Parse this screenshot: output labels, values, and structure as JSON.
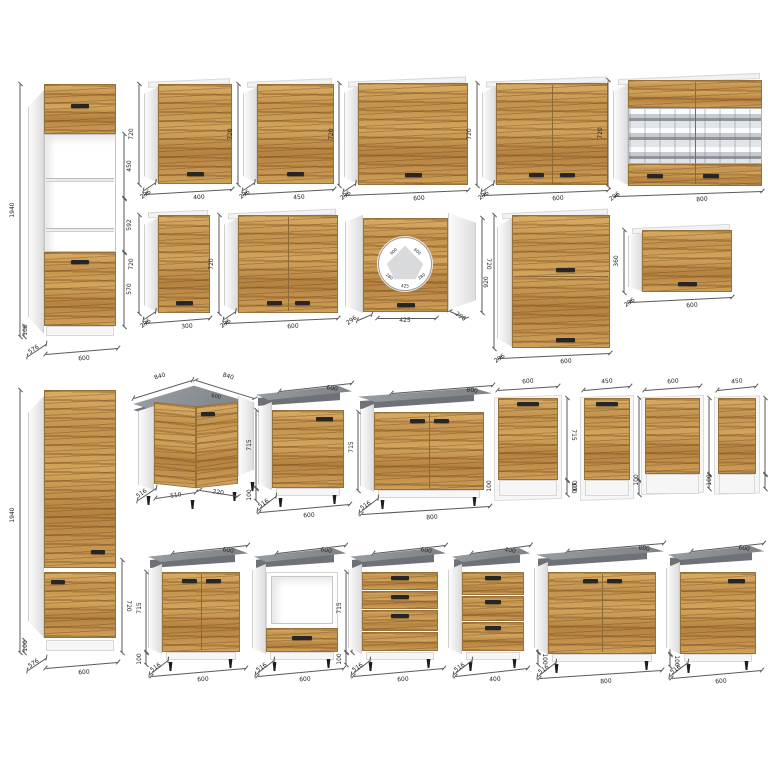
{
  "title": "kitchen-cabinet-modules-catalog",
  "colors": {
    "wood": "#c89a57",
    "carcass_white": "#fdfdfd",
    "countertop_gray": "#8d9296",
    "countertop_edge": "#6e7277",
    "handle_dark": "#262626",
    "dimension_text": "#1f1f1f",
    "background": "#ffffff"
  },
  "modules": [
    {
      "kind": "tallA",
      "name": "tall-cabinet-oven-housing-1940",
      "g": {
        "x": 44,
        "y": 84,
        "w": 72,
        "h": 252
      },
      "labels": {
        "height": "1940",
        "sec1": "450",
        "sec2": "592",
        "sec3": "570",
        "plinth": "100",
        "depth": "576",
        "width": "600"
      }
    },
    {
      "kind": "wall",
      "name": "wall-cabinet-400",
      "g": {
        "x": 158,
        "y": 84,
        "w": 74,
        "h": 100,
        "doors": 1
      },
      "labels": {
        "width": "400",
        "height": "720",
        "depth": "296"
      }
    },
    {
      "kind": "wall",
      "name": "wall-cabinet-450",
      "g": {
        "x": 257,
        "y": 84,
        "w": 77,
        "h": 100,
        "doors": 1
      },
      "labels": {
        "width": "450",
        "height": "720",
        "depth": "296"
      }
    },
    {
      "kind": "wall",
      "name": "wall-cabinet-600",
      "g": {
        "x": 358,
        "y": 83,
        "w": 110,
        "h": 102,
        "doors": 1
      },
      "labels": {
        "width": "600",
        "height": "720",
        "depth": "296"
      }
    },
    {
      "kind": "wall",
      "name": "wall-cabinet-600-two-door",
      "g": {
        "x": 496,
        "y": 83,
        "w": 112,
        "h": 102,
        "doors": 2
      },
      "labels": {
        "width": "600",
        "height": "720",
        "depth": "296"
      }
    },
    {
      "kind": "wallGlass",
      "name": "wall-cabinet-800-glass",
      "g": {
        "x": 628,
        "y": 80,
        "w": 134,
        "h": 106
      },
      "labels": {
        "width": "800",
        "height": "720",
        "depth": "296"
      }
    },
    {
      "kind": "wall",
      "name": "wall-cabinet-300",
      "g": {
        "x": 158,
        "y": 215,
        "w": 52,
        "h": 98,
        "doors": 1
      },
      "labels": {
        "width": "300",
        "height": "720",
        "depth": "296"
      }
    },
    {
      "kind": "wall",
      "name": "wall-cabinet-600-two-door-b",
      "g": {
        "x": 238,
        "y": 215,
        "w": 100,
        "h": 98,
        "doors": 2
      },
      "labels": {
        "width": "600",
        "height": "720",
        "depth": "296"
      }
    },
    {
      "kind": "wallCorner",
      "name": "wall-corner-cabinet-600",
      "g": {
        "x": 345,
        "y": 213
      },
      "labels": {
        "front": "425",
        "height": "720",
        "depth_left": "296",
        "depth_right": "296",
        "plan": [
          "600",
          "600",
          "280",
          "280",
          "425"
        ]
      }
    },
    {
      "kind": "wallStack",
      "name": "wall-cabinet-600-920-stacked",
      "g": {
        "x": 512,
        "y": 215,
        "w": 98,
        "h": 133
      },
      "labels": {
        "width": "600",
        "height": "920",
        "depth": "296"
      }
    },
    {
      "kind": "wallHoriz",
      "name": "wall-cabinet-600-360-horizontal",
      "g": {
        "x": 642,
        "y": 230,
        "w": 90,
        "h": 62
      },
      "labels": {
        "width": "600",
        "height": "360",
        "depth": "296"
      }
    },
    {
      "kind": "tallB",
      "name": "tall-cabinet-1940-fridge",
      "g": {
        "x": 44,
        "y": 390,
        "w": 72,
        "h": 250
      },
      "labels": {
        "height": "1940",
        "section": "720",
        "plinth": "100",
        "depth": "576",
        "width": "600"
      }
    },
    {
      "kind": "baseCorner",
      "name": "base-corner-cabinet-840",
      "g": {
        "x": 128
      },
      "labels": {
        "top_left": "840",
        "top_right": "840",
        "counter": "600",
        "depth": "516",
        "front_left": "510",
        "front_right": "220"
      }
    },
    {
      "kind": "base",
      "name": "base-cabinet-600-door",
      "g": {
        "x": 256,
        "y": 386,
        "cw": 96,
        "fx": 272,
        "fy": 410,
        "fw": 72,
        "fh": 78,
        "type": "door1",
        "hside": "left"
      },
      "labels": {
        "top": "600",
        "height": "715",
        "plinth": "100",
        "depth": "516",
        "width": "600"
      }
    },
    {
      "kind": "base",
      "name": "base-cabinet-800-two-door",
      "g": {
        "x": 358,
        "y": 388,
        "cw": 134,
        "fx": 374,
        "fy": 412,
        "fw": 110,
        "fh": 78,
        "type": "door2",
        "hside": "left"
      },
      "labels": {
        "top": "800",
        "height": "715",
        "depth": "516",
        "width": "800"
      }
    },
    {
      "kind": "dw",
      "name": "dishwasher-front-600-715",
      "g": {
        "x": 498,
        "y": 398,
        "w": 60,
        "h": 82,
        "handle": true
      },
      "labels": {
        "top": "600",
        "height": "715",
        "plinth": "100"
      }
    },
    {
      "kind": "dw",
      "name": "dishwasher-front-450-715",
      "g": {
        "x": 584,
        "y": 398,
        "w": 46,
        "h": 82,
        "handle": true
      },
      "labels": {
        "top": "450",
        "height": "715",
        "plinth": "100"
      }
    },
    {
      "kind": "dw",
      "name": "dishwasher-front-600-570",
      "g": {
        "x": 645,
        "y": 398,
        "w": 55,
        "h": 76,
        "handle": false
      },
      "labels": {
        "top": "600",
        "height": "570",
        "plinth": "100"
      }
    },
    {
      "kind": "dw",
      "name": "dishwasher-front-450-570",
      "g": {
        "x": 718,
        "y": 398,
        "w": 38,
        "h": 76,
        "handle": false
      },
      "labels": {
        "top": "450",
        "height": "570",
        "plinth": "100"
      }
    },
    {
      "kind": "base",
      "name": "base-cabinet-600-two-door-sink",
      "g": {
        "x": 148,
        "y": 548,
        "cw": 100,
        "fx": 162,
        "fy": 572,
        "fw": 78,
        "fh": 80,
        "type": "door2",
        "hside": "left"
      },
      "labels": {
        "top": "600",
        "height": "715",
        "plinth": "100",
        "depth": "516",
        "width": "600"
      }
    },
    {
      "kind": "base",
      "name": "base-cabinet-oven-housing-600",
      "g": {
        "x": 254,
        "y": 548,
        "cw": 92,
        "fx": 266,
        "fy": 572,
        "fw": 72,
        "fh": 80,
        "type": "oven",
        "hside": "right"
      },
      "labels": {
        "top": "600",
        "height": "715",
        "depth": "516",
        "width": "600"
      }
    },
    {
      "kind": "base",
      "name": "base-cabinet-600-drawers",
      "g": {
        "x": 350,
        "y": 548,
        "cw": 96,
        "fx": 362,
        "fy": 572,
        "fw": 76,
        "fh": 80,
        "type": "drawers4",
        "hside": "left"
      },
      "labels": {
        "top": "600",
        "height": "715",
        "plinth": "100",
        "depth": "516",
        "width": "600"
      }
    },
    {
      "kind": "base",
      "name": "base-cabinet-400-drawers",
      "g": {
        "x": 452,
        "y": 548,
        "cw": 78,
        "fx": 462,
        "fy": 572,
        "fw": 62,
        "fh": 80,
        "type": "drawers3",
        "hside": "right"
      },
      "labels": {
        "top": "400",
        "height": "715",
        "plinth": "100",
        "depth": "516",
        "width": "400"
      }
    },
    {
      "kind": "base",
      "name": "base-cabinet-800-two-door-b",
      "g": {
        "x": 536,
        "y": 546,
        "cw": 128,
        "fx": 548,
        "fy": 572,
        "fw": 108,
        "fh": 82,
        "type": "door2",
        "hside": "right"
      },
      "labels": {
        "top": "800",
        "height": "715",
        "plinth": "100",
        "depth": "516",
        "width": "800"
      }
    },
    {
      "kind": "base",
      "name": "base-cabinet-600-door-b",
      "g": {
        "x": 668,
        "y": 546,
        "cw": 96,
        "fx": 680,
        "fy": 572,
        "fw": 76,
        "fh": 82,
        "type": "door1",
        "hside": "right"
      },
      "labels": {
        "top": "600",
        "height": "715",
        "depth": "516",
        "width": "600"
      }
    }
  ]
}
